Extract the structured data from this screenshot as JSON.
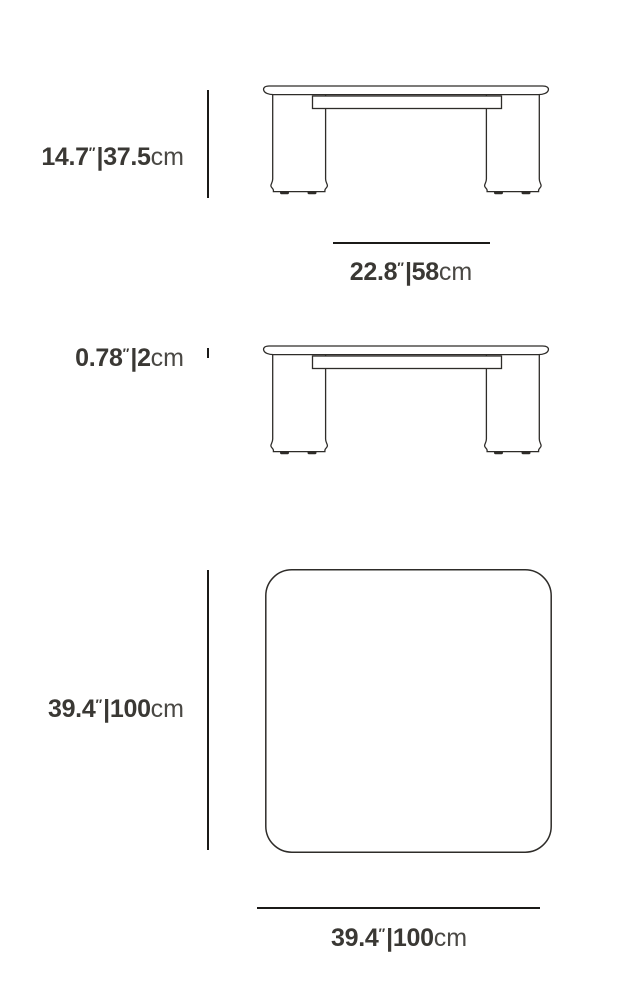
{
  "diagram": {
    "title": "Square coffee table dimensions diagram",
    "views": {
      "side_view_height": "table-side-view-with-height",
      "side_view_thickness": "table-side-view-with-top-thickness",
      "top_view": "table-top-view"
    },
    "labels": {
      "height": {
        "inches": "14.7",
        "inch_mark": "″",
        "separator": "|",
        "metric": "37.5",
        "metric_unit": "cm"
      },
      "leg_span": {
        "inches": "22.8",
        "inch_mark": "″",
        "separator": "|",
        "metric": "58",
        "metric_unit": "cm"
      },
      "top_thickness": {
        "inches": "0.78",
        "inch_mark": "″",
        "separator": "|",
        "metric": "2",
        "metric_unit": "cm"
      },
      "depth": {
        "inches": "39.4",
        "inch_mark": "″",
        "separator": "|",
        "metric": "100",
        "metric_unit": "cm"
      },
      "width": {
        "inches": "39.4",
        "inch_mark": "″",
        "separator": "|",
        "metric": "100",
        "metric_unit": "cm"
      }
    },
    "colors": {
      "background": "#ffffff",
      "label_text": "#3a3834",
      "unit_text": "#4a4844",
      "drawing_stroke": "#2e2c29",
      "dimension_line": "#1b1a18"
    }
  }
}
